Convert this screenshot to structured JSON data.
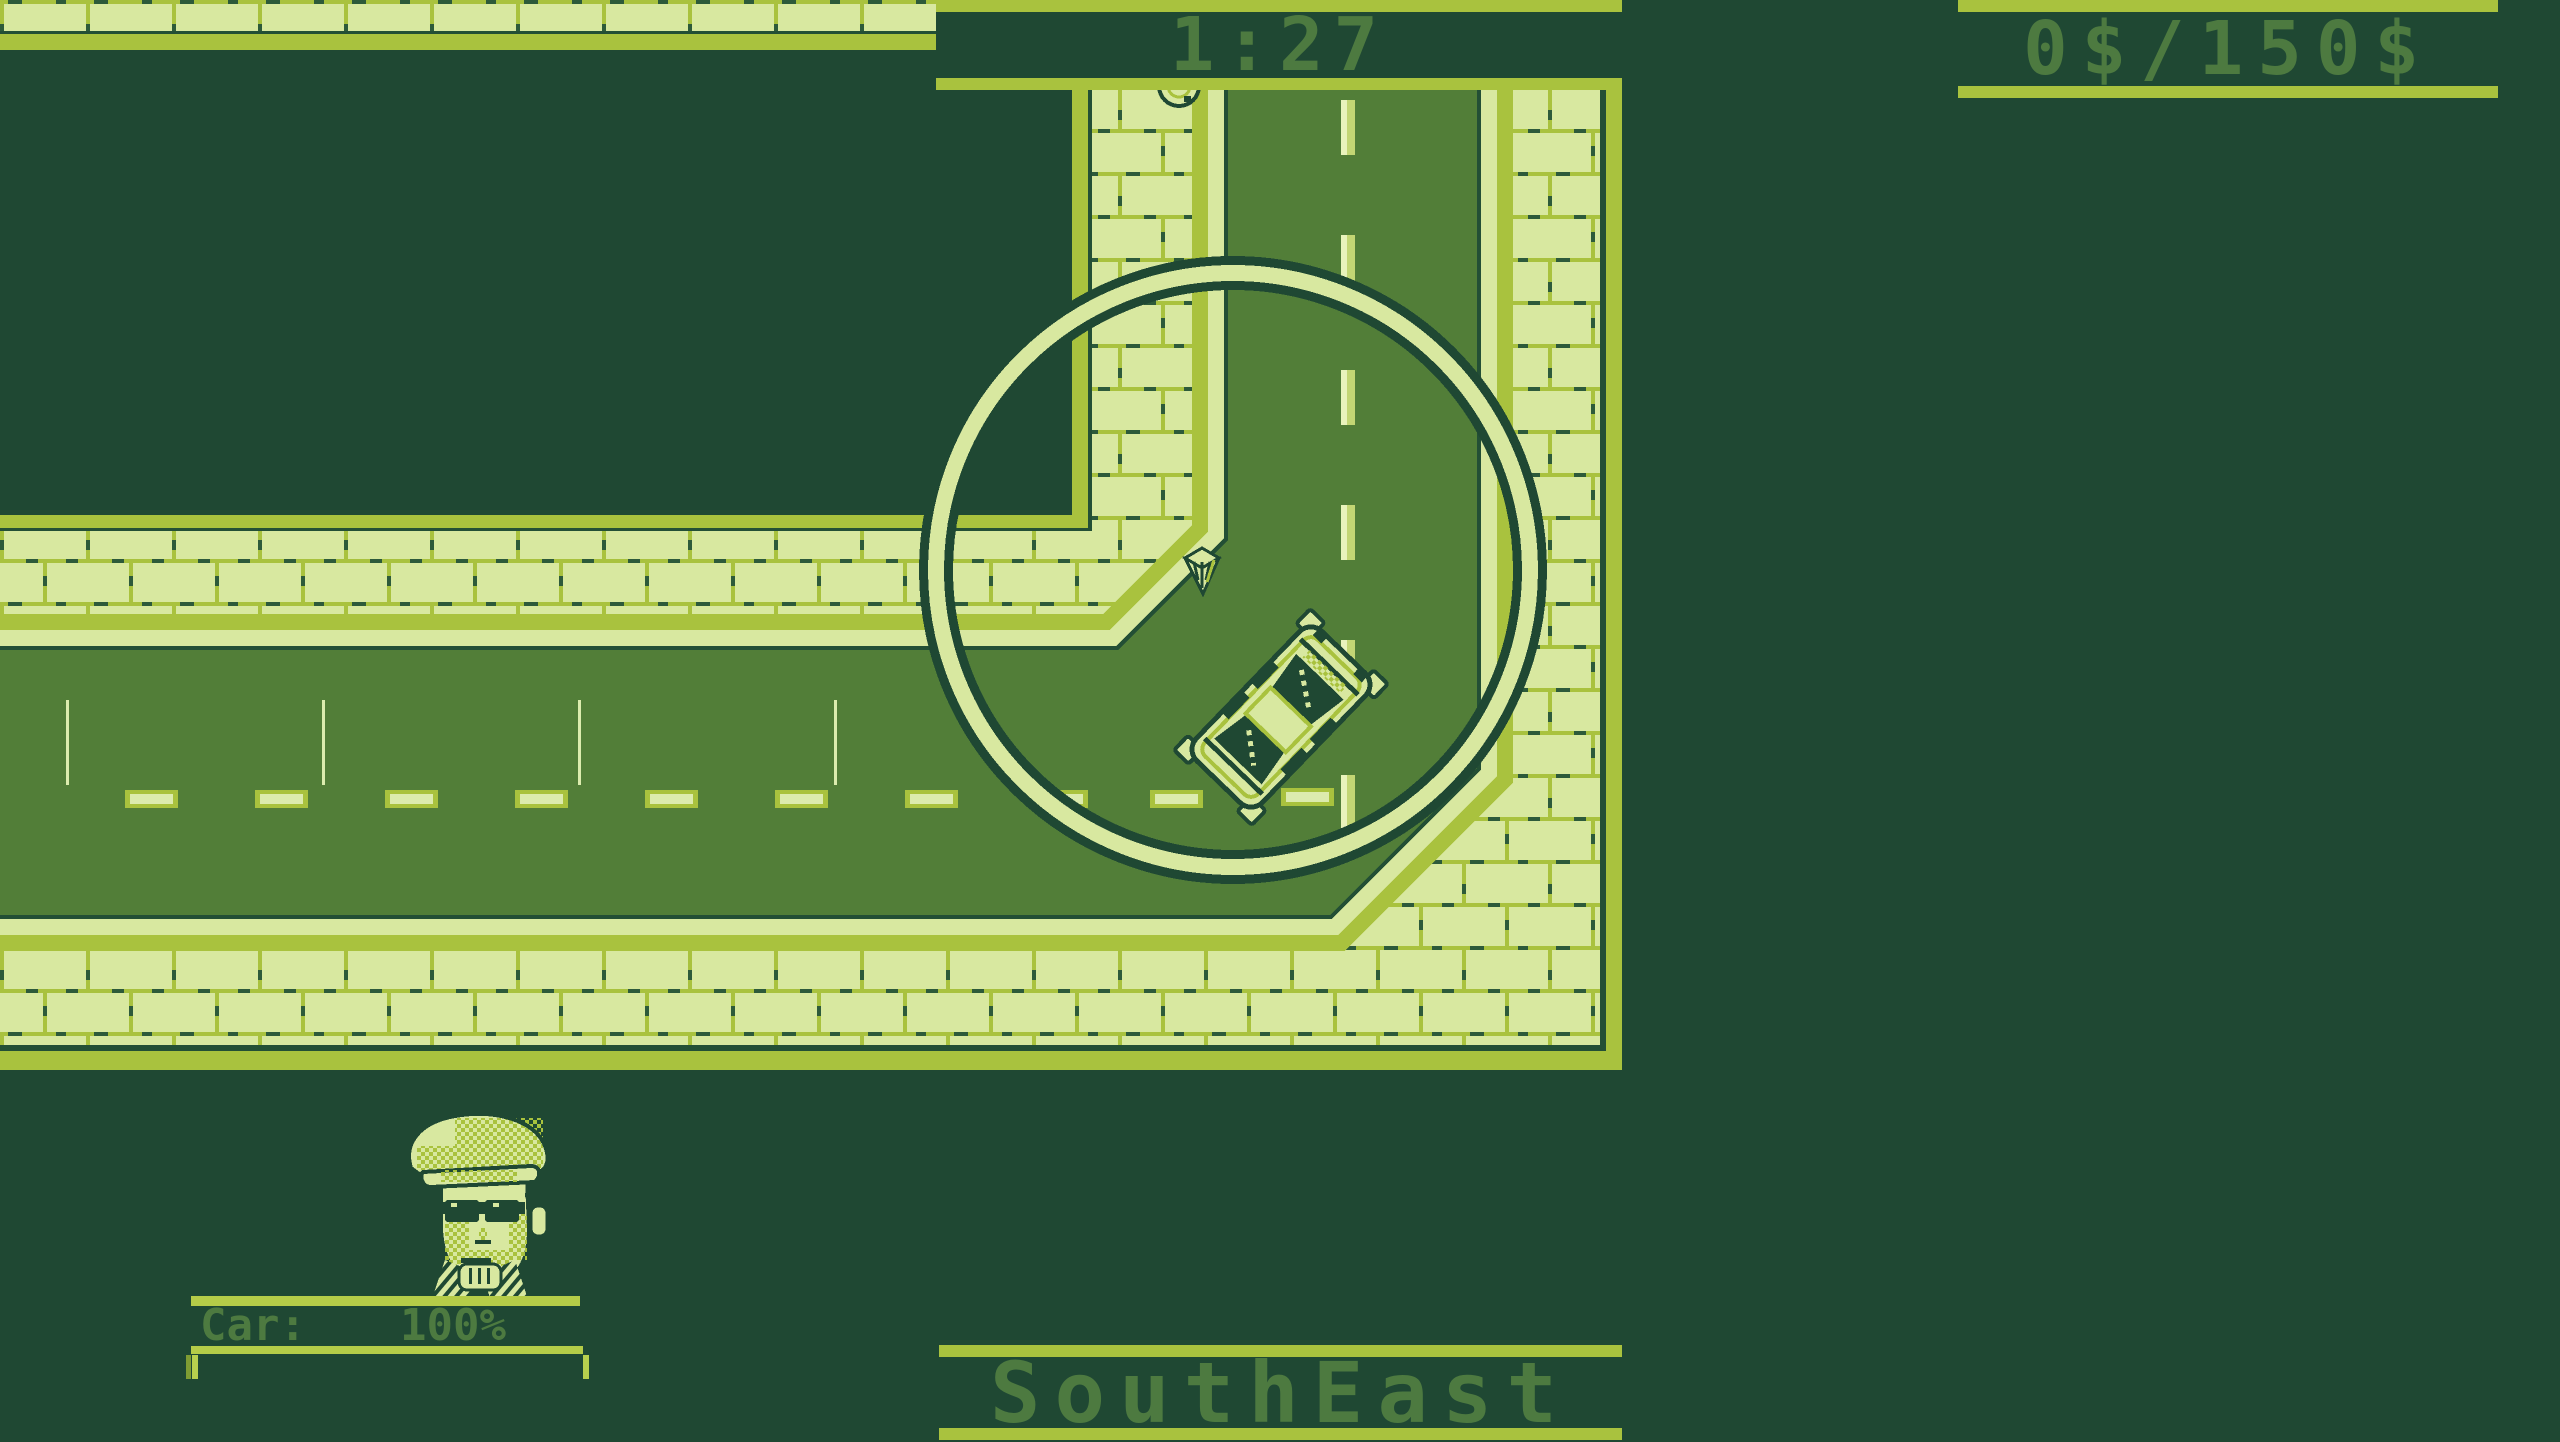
{
  "hud": {
    "timer": {
      "value": "1:27"
    },
    "money": {
      "value": "0$/150$"
    },
    "compass": {
      "value": "SouthEast"
    },
    "car_status": {
      "label": "Car:",
      "value": "100%"
    }
  },
  "palette": {
    "darkest_green": "#1f4833",
    "road_green": "#527e38",
    "olive_green": "#a9c23e",
    "pale_green": "#d8e8a0",
    "bright_pale": "#e9f3bc",
    "hud_text_green": "#4d7a40"
  },
  "sprites": {
    "player_car": "taxi-top-view-facing-northeast",
    "destination_marker": "waypoint-arrow-down",
    "destination_ring": "large-circle-outline",
    "manhole": "manhole-cover-half-visible",
    "portrait": "driver-with-flat-cap-sunglasses-holding-steering-wheel"
  }
}
